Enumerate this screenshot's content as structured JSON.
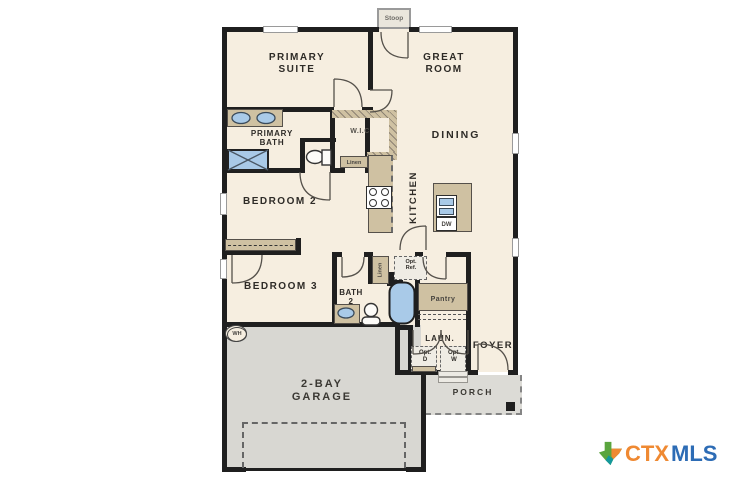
{
  "labels": {
    "stoop": "Stoop",
    "primary_suite": "PRIMARY SUITE",
    "great_room": "GREAT ROOM",
    "primary_bath": "PRIMARY BATH",
    "wic": "W.I.C",
    "dining": "DINING",
    "linen_hall": "Linen",
    "bedroom2": "BEDROOM 2",
    "kitchen": "KITCHEN",
    "dw": "DW",
    "opt_ref": "Opt. Ref.",
    "bedroom3": "BEDROOM 3",
    "bath2": "BATH 2",
    "linen_bath": "Linen",
    "pantry": "Pantry",
    "wh": "WH",
    "laundry": "LAUN.",
    "opt_d": "Opt. D",
    "opt_w": "Opt. W",
    "foyer": "FOYER",
    "garage": "2-BAY GARAGE",
    "porch": "PORCH"
  },
  "logo": {
    "ctx": "CTX",
    "mls": "MLS"
  },
  "colors": {
    "wall": "#1f1f1f",
    "floor": "#f6eee0",
    "garage": "#d8d7d2",
    "porch": "#dcdbd6",
    "counter": "#cfc1a2",
    "fixture_blue": "#a9cae8",
    "window_gray": "#9a9a9a",
    "text_dark": "#2e2b27",
    "logo_orange": "#ef8932",
    "logo_blue": "#2d6cb5",
    "logo_green": "#5aa53e",
    "logo_teal": "#14989c"
  }
}
